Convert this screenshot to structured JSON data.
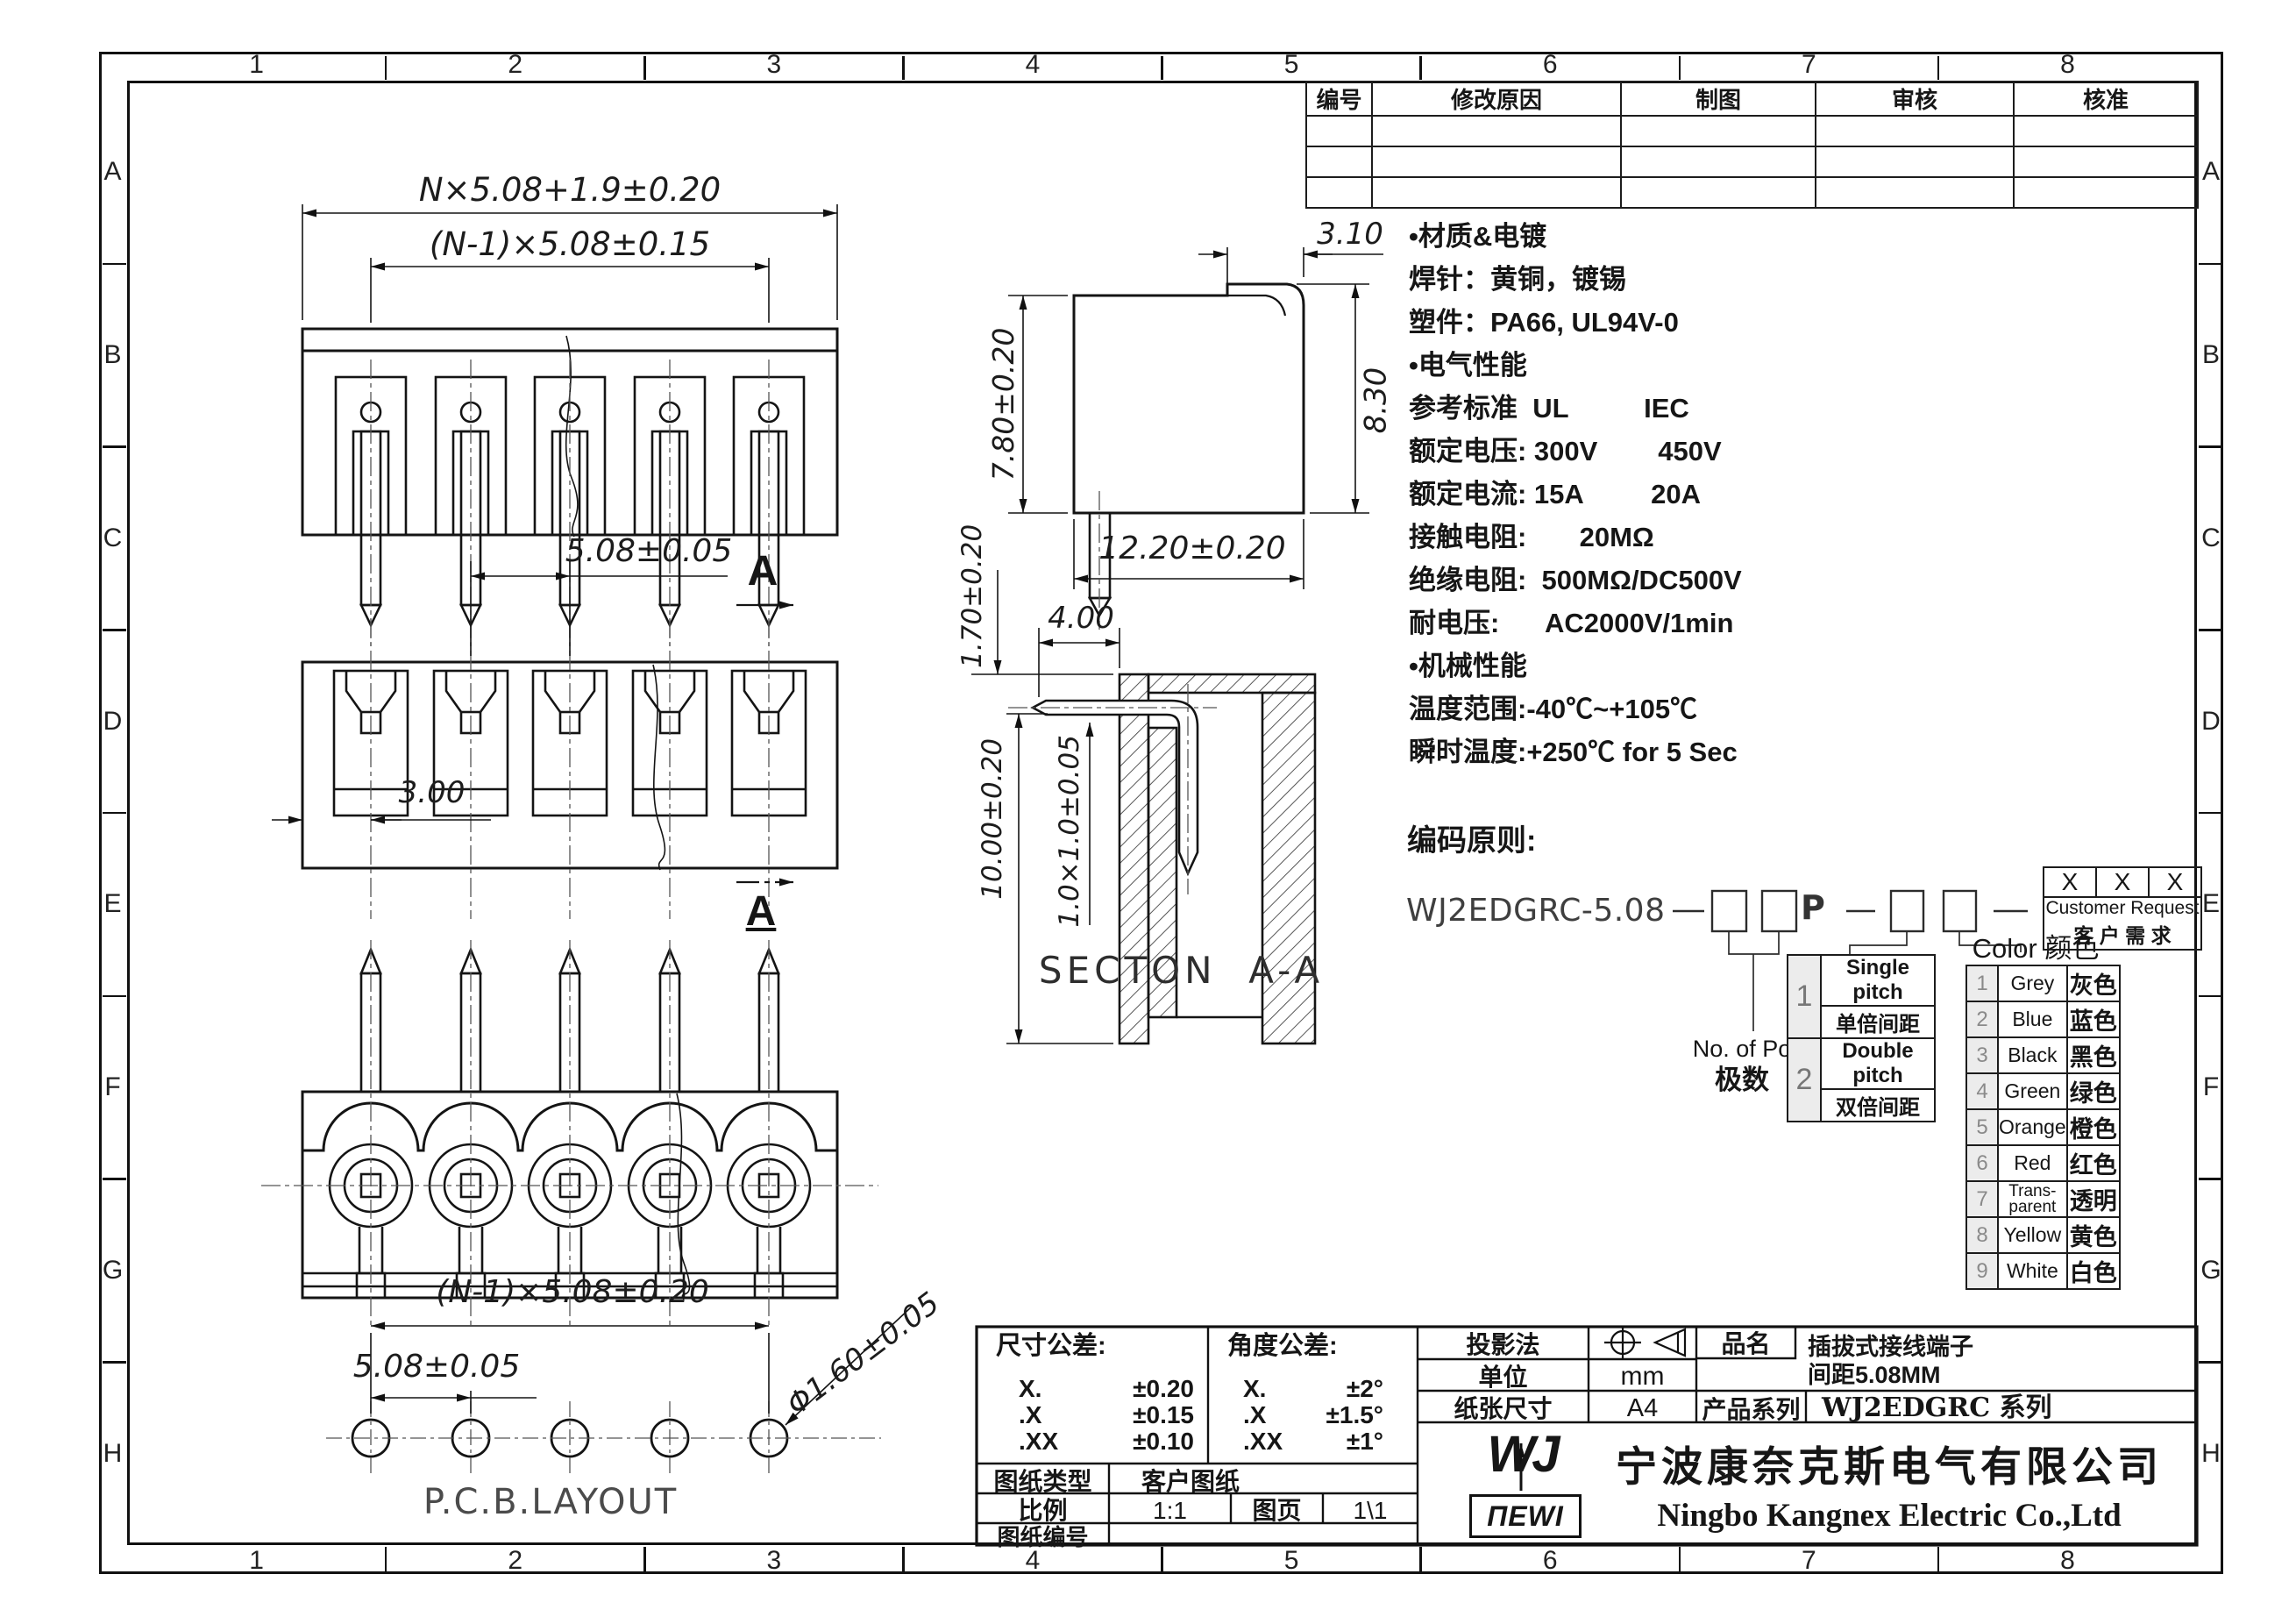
{
  "frame": {
    "cols": [
      "1",
      "2",
      "3",
      "4",
      "5",
      "6",
      "7",
      "8"
    ],
    "rows": [
      "A",
      "B",
      "C",
      "D",
      "E",
      "F",
      "G",
      "H"
    ]
  },
  "revision_table": {
    "headers": [
      "编号",
      "修改原因",
      "制图",
      "审核",
      "核准"
    ],
    "empty_row_count": 3
  },
  "specs": {
    "lines": [
      "•材质&电镀",
      "焊针：黄铜，镀锡",
      "塑件：PA66, UL94V-0",
      "•电气性能",
      "参考标准  UL          IEC",
      "额定电压: 300V        450V",
      "额定电流: 15A         20A",
      "接触电阻:       20MΩ",
      "绝缘电阻:  500MΩ/DC500V",
      "耐电压:      AC2000V/1min",
      "•机械性能",
      "温度范围:-40℃~+105℃",
      "瞬时温度:+250℃ for 5 Sec"
    ]
  },
  "coding": {
    "title": "编码原则:",
    "part": "WJ2EDGRC-5.08",
    "p": "P",
    "pole_en": "No. of Pole",
    "pole_cn": "极数",
    "pitch_rows": [
      {
        "no": "1",
        "en": "Single pitch",
        "cn": "单倍间距"
      },
      {
        "no": "2",
        "en": "Double pitch",
        "cn": "双倍间距"
      }
    ],
    "color_title": "Color 颜色",
    "color_rows": [
      {
        "no": "1",
        "en": "Grey",
        "cn": "灰色"
      },
      {
        "no": "2",
        "en": "Blue",
        "cn": "蓝色"
      },
      {
        "no": "3",
        "en": "Black",
        "cn": "黑色"
      },
      {
        "no": "4",
        "en": "Green",
        "cn": "绿色"
      },
      {
        "no": "5",
        "en": "Orange",
        "cn": "橙色"
      },
      {
        "no": "6",
        "en": "Red",
        "cn": "红色"
      },
      {
        "no": "7",
        "en": "Trans-parent",
        "cn": "透明"
      },
      {
        "no": "8",
        "en": "Yellow",
        "cn": "黄色"
      },
      {
        "no": "9",
        "en": "White",
        "cn": "白色"
      }
    ],
    "customer": {
      "x1": "X",
      "x2": "X",
      "x3": "X",
      "en": "Customer Request",
      "cn": "客 户 需 求"
    }
  },
  "views": {
    "front": {
      "dim_overall": "N×5.08+1.9±0.20",
      "dim_pitch": "(N-1)×5.08±0.15"
    },
    "bottom": {
      "dim_pitch": "5.08±0.05",
      "dim_edge": "3.00",
      "section_marker": "A"
    },
    "side": {
      "dim_top": "3.10",
      "dim_left": "7.80±0.20",
      "dim_right": "8.30",
      "dim_bottom": "12.20±0.20"
    },
    "section": {
      "label": "SECTON  A-A",
      "dim_a": "1.70±0.20",
      "dim_b": "4.00",
      "dim_c": "10.00±0.20",
      "dim_d": "1.0×1.0±0.05"
    },
    "pcb": {
      "label": "P.C.B.LAYOUT",
      "dim_overall": "(N-1)×5.08±0.20",
      "dim_pitch": "5.08±0.05",
      "dim_hole": "Φ1.60±0.05"
    }
  },
  "title_block": {
    "dim_tol_title": "尺寸公差:",
    "dim_tol_rows": [
      [
        "X.",
        "±0.20"
      ],
      [
        ".X",
        "±0.15"
      ],
      [
        ".XX",
        "±0.10"
      ]
    ],
    "ang_tol_title": "角度公差:",
    "ang_tol_rows": [
      [
        "X.",
        "±2°"
      ],
      [
        ".X",
        "±1.5°"
      ],
      [
        ".XX",
        "±1°"
      ]
    ],
    "type_label": "图纸类型",
    "type_value": "客户图纸",
    "scale_label": "比例",
    "scale_value": "1:1",
    "sheet_label": "图页",
    "sheet_value": "1\\1",
    "no_label": "图纸编号",
    "no_value": "",
    "proj_label": "投影法",
    "unit_label": "单位",
    "unit_value": "mm",
    "paper_label": "纸张尺寸",
    "paper_value": "A4",
    "product_label": "品名",
    "product_line1": "插拔式接线端子",
    "product_line2": "间距5.08MM",
    "series_label": "产品系列",
    "series_value": "WJ2EDGRC 系列"
  },
  "company": {
    "logo_monogram": "WJ",
    "logo_wordmark": "ПEWI",
    "name_cn": "宁波康奈克斯电气有限公司",
    "name_en": "Ningbo Kangnex Electric Co.,Ltd"
  }
}
